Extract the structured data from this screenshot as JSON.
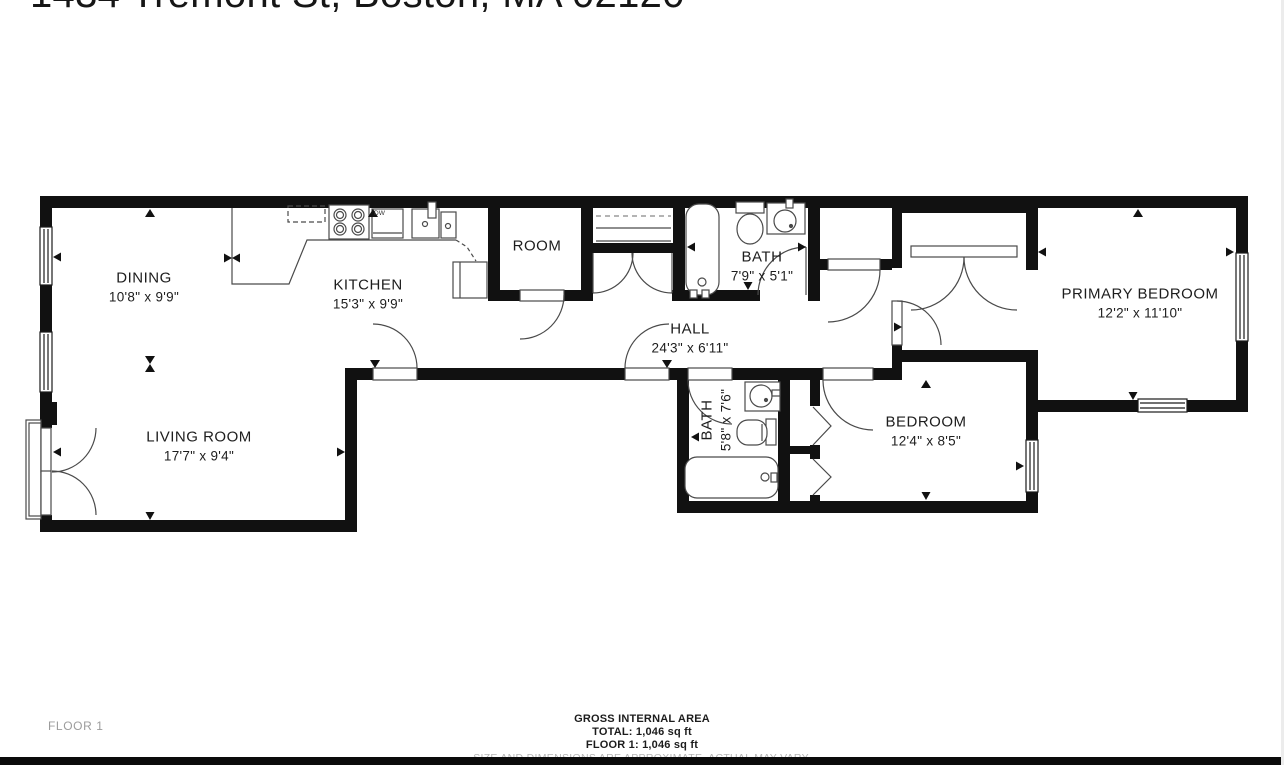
{
  "title": {
    "address": "1434 Tremont St, Boston, MA 02120"
  },
  "floorplan": {
    "rooms": {
      "dining": {
        "name": "DINING",
        "dims": "10'8\" x 9'9\""
      },
      "kitchen": {
        "name": "KITCHEN",
        "dims": "15'3\" x 9'9\""
      },
      "living_room": {
        "name": "LIVING ROOM",
        "dims": "17'7\" x 9'4\""
      },
      "room": {
        "name": "ROOM",
        "dims": ""
      },
      "bath_upper": {
        "name": "BATH",
        "dims": "7'9\" x 5'1\""
      },
      "hall": {
        "name": "HALL",
        "dims": "24'3\" x 6'11\""
      },
      "primary_bedroom": {
        "name": "PRIMARY BEDROOM",
        "dims": "12'2\" x 11'10\""
      },
      "bath_lower": {
        "name": "BATH",
        "dims": "5'8\" x 7'6\""
      },
      "bedroom": {
        "name": "BEDROOM",
        "dims": "12'4\" x 8'5\""
      }
    },
    "appliances": {
      "dishwasher": "DW"
    }
  },
  "footer": {
    "floor_label": "FLOOR 1",
    "gross_area_title": "GROSS INTERNAL AREA",
    "total": "TOTAL: 1,046 sq ft",
    "floor_total": "FLOOR 1: 1,046 sq ft",
    "disclaimer": "SIZE AND DIMENSIONS ARE APPROXIMATE, ACTUAL MAY VARY."
  },
  "colors": {
    "wall": "#111111",
    "fixture_line": "#4a4a4a",
    "label": "#1d1d1d",
    "muted": "#9c9c9c",
    "bottom_bar": "#0b0b0b"
  }
}
